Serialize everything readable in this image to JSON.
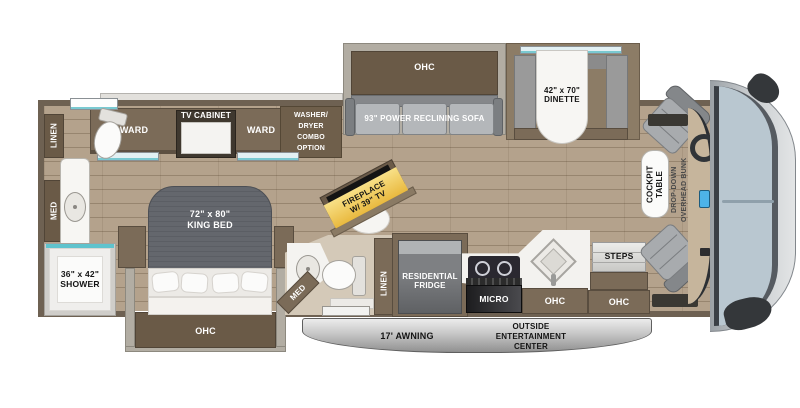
{
  "title": "Class A motorhome floor plan",
  "colors": {
    "wall": "#6e6152",
    "cabinet": "#7b6b58",
    "floor": "#b4a28c",
    "glass_teal": "#79c9d1",
    "windshield": "#b9c7d0",
    "fireplace_yellow": "#f3c957",
    "awning_gray": "#b9b9b9"
  },
  "labels": {
    "rear_bath": {
      "linen": "LINEN",
      "med": "MED",
      "shower": "36\" x 42\"\nSHOWER"
    },
    "bedroom": {
      "ward_left": "WARD",
      "tv_cabinet": "TV CABINET",
      "ward_right": "WARD",
      "washer_dryer": "WASHER/\nDRYER\nCOMBO\nOPTION",
      "king_bed": "72\" x 80\"\nKING BED",
      "ohc": "OHC"
    },
    "living": {
      "ohc": "OHC",
      "sofa": "93\" POWER RECLINING SOFA",
      "dinette": "42\" x 70\"\nDINETTE",
      "fireplace": "FIREPLACE\nW/ 39\" TV"
    },
    "mid_bath": {
      "med": "MED",
      "linen": "LINEN"
    },
    "kitchen": {
      "fridge": "RESIDENTIAL\nFRIDGE",
      "micro": "MICRO",
      "ohc": "OHC"
    },
    "entry": {
      "steps": "STEPS",
      "ohc": "OHC"
    },
    "cockpit": {
      "table": "COCKPIT\nTABLE",
      "bunk": "DROP-DOWN\nOVERHEAD BUNK\nOPTION"
    },
    "exterior": {
      "awning": "17' AWNING",
      "entertainment": "OUTSIDE\nENTERTAINMENT\nCENTER"
    }
  }
}
